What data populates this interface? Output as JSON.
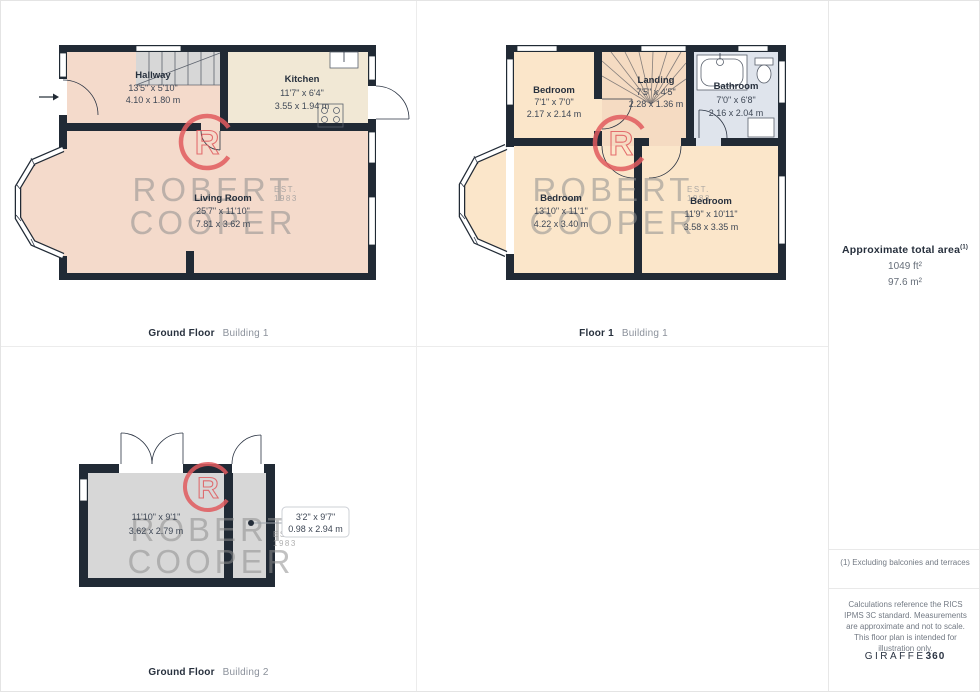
{
  "captions": [
    {
      "floor": "Ground Floor",
      "building": "Building 1"
    },
    {
      "floor": "Floor 1",
      "building": "Building 1"
    },
    {
      "floor": "Ground Floor",
      "building": "Building 2"
    }
  ],
  "watermark": {
    "logo_letter": "R",
    "line1": "ROBERT",
    "line2": "COOPER",
    "est": "EST.",
    "year": "1983"
  },
  "plans": [
    {
      "rooms": [
        {
          "name": "Hallway",
          "imperial": "13'5\" x 5'10\"",
          "metric": "4.10 x 1.80 m"
        },
        {
          "name": "Kitchen",
          "imperial": "11'7\" x 6'4\"",
          "metric": "3.55 x 1.94 m"
        },
        {
          "name": "Living Room",
          "imperial": "25'7\" x 11'10\"",
          "metric": "7.81 x 3.62 m"
        }
      ]
    },
    {
      "rooms": [
        {
          "name": "Bedroom",
          "imperial": "7'1\" x 7'0\"",
          "metric": "2.17 x 2.14 m"
        },
        {
          "name": "Landing",
          "imperial": "7'5\" x 4'5\"",
          "metric": "2.28 x 1.36 m"
        },
        {
          "name": "Bathroom",
          "imperial": "7'0\" x 6'8\"",
          "metric": "2.16 x 2.04 m"
        },
        {
          "name": "Bedroom",
          "imperial": "13'10\" x 11'1\"",
          "metric": "4.22 x 3.40 m"
        },
        {
          "name": "Bedroom",
          "imperial": "11'9\" x 10'11\"",
          "metric": "3.58 x 3.35 m"
        }
      ]
    },
    {
      "rooms": [
        {
          "imperial": "11'10\" x 9'1\"",
          "metric": "3.62 x 2.79 m"
        }
      ],
      "callout": {
        "imperial": "3'2\" x 9'7\"",
        "metric": "0.98 x 2.94 m"
      }
    }
  ],
  "sidebar": {
    "area_title": "Approximate total area",
    "area_superscript": "(1)",
    "area_ft": "1049 ft²",
    "area_m": "97.6 m²",
    "footnote": "(1) Excluding balconies and terraces",
    "disclaimer": "Calculations reference the RICS IPMS 3C standard. Measurements are approximate and not to scale. This floor plan is intended for illustration only.",
    "brand_name": "GIRAFFE",
    "brand_number": "360"
  },
  "colors": {
    "wall": "#212a35",
    "floor_pink": "#f4dacb",
    "floor_cream": "#f1e8d5",
    "floor_peach": "#fbe6ca",
    "floor_landing": "#f5dbc2",
    "floor_bath": "#dfe4ec",
    "floor_gray": "#d7d7d7",
    "logo_red": "#e05a5e",
    "watermark_gray": "#8f8f8f"
  }
}
